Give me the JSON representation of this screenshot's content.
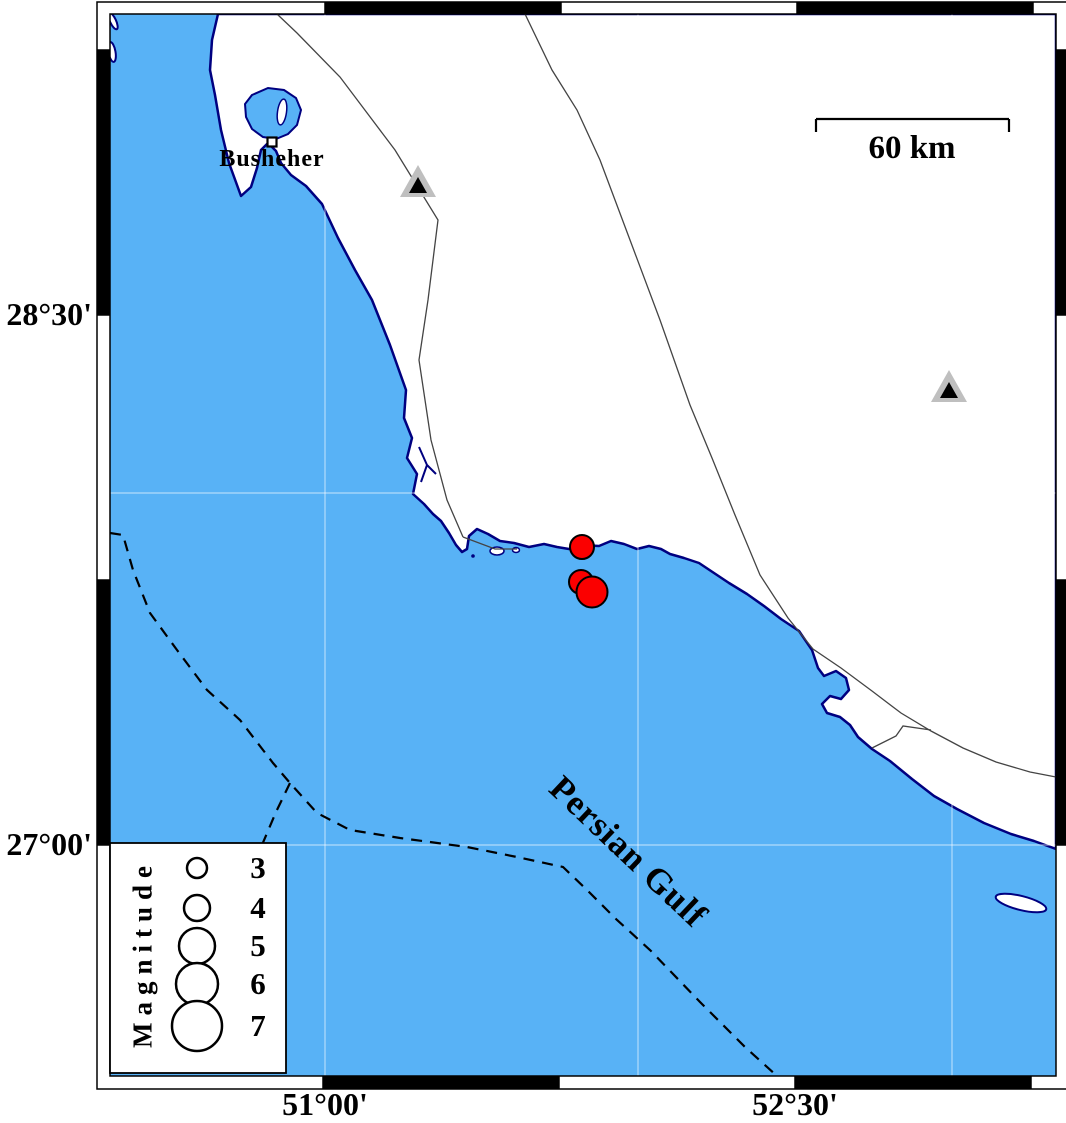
{
  "map_frame": {
    "axis_labels": {
      "lat": [
        {
          "text": "28°30'"
        },
        {
          "text": "27°00'"
        }
      ],
      "lon": [
        {
          "text": "51°00'"
        },
        {
          "text": "52°30'"
        }
      ]
    }
  },
  "labels": {
    "city": "Busheher",
    "sea": "Persian Gulf",
    "scale": "60 km",
    "legend_title": "Magnitude"
  },
  "legend": {
    "entries": [
      {
        "label": "3",
        "r": 10,
        "y": 868
      },
      {
        "label": "4",
        "r": 13,
        "y": 908
      },
      {
        "label": "5",
        "r": 18,
        "y": 946
      },
      {
        "label": "6",
        "r": 21,
        "y": 984
      },
      {
        "label": "7",
        "r": 25,
        "y": 1026
      }
    ],
    "circle_x": 197
  },
  "markers": {
    "earthquakes": [
      {
        "x": 582,
        "y": 547,
        "r": 12
      },
      {
        "x": 581,
        "y": 582,
        "r": 12
      },
      {
        "x": 592,
        "y": 592,
        "r": 15.5
      }
    ],
    "stations": [
      {
        "x": 418,
        "y": 185
      },
      {
        "x": 949,
        "y": 390
      }
    ],
    "city": {
      "x": 272,
      "y": 142
    }
  },
  "graticule": {
    "vertical": [
      325,
      638,
      952
    ],
    "horizontal": [
      493,
      845
    ]
  },
  "colors": {
    "sea": "#58B2F6",
    "land": "#FFFFFF",
    "coast": "#000080",
    "earthquake": "#FB0000",
    "station_halo": "#BFBFBF",
    "station_fill": "#000000",
    "grid": "rgba(255,255,255,0.55)"
  }
}
